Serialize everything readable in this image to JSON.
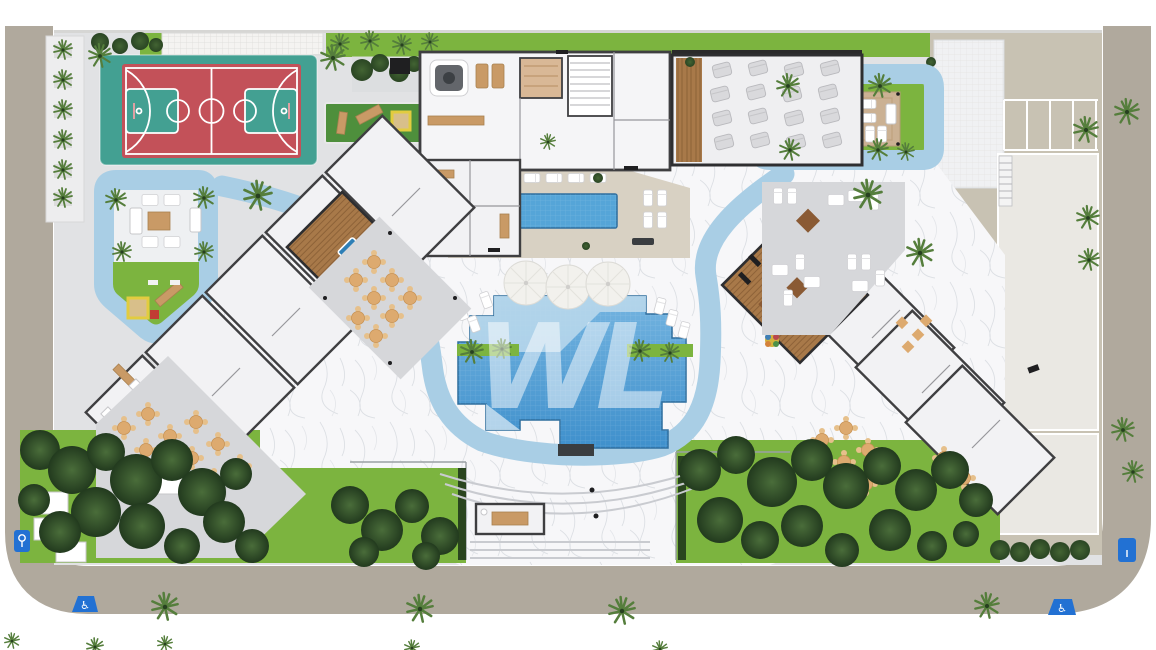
{
  "canvas": {
    "width": 1156,
    "height": 650
  },
  "watermark": {
    "letters": "WL"
  },
  "signs": {
    "handicap_glyph": "♿"
  },
  "palette": {
    "page_bg": "#ffffff",
    "road": "#b0a99d",
    "curb": "#ffffff",
    "concrete": "#e1e2e4",
    "concrete_dark": "#d6d7da",
    "marble": "#f7f7f9",
    "marble_vein": "#d6d9de",
    "deck_beige": "#d8d1c3",
    "roof_beige": "#c8c2b3",
    "panel_light": "#eae8e3",
    "panel_white": "#f0f1f3",
    "water": "#4e9fd4",
    "water_deep": "#3f90cc",
    "water_pale": "#bcd9ec",
    "water_light": "#a9cee5",
    "lap_water": "#55a5d8",
    "court_teal": "#43a092",
    "court_red": "#c35159",
    "line_white": "#ffffff",
    "lawn": "#7cb43f",
    "lawn_dark": "#5f9a33",
    "tree_dark": "#2a451f",
    "tree_mid": "#41642f",
    "tree_light": "#557e3c",
    "wood": "#a87949",
    "wood_dark": "#88603a",
    "wood_light": "#c99a66",
    "pool_table": "#2e7fb6",
    "sand": "#d8bf8a",
    "sand_frame": "#e2cc3f",
    "furn_white": "#ffffff",
    "furn_gray": "#d9d9dc",
    "furn_edge": "#b9b9bd",
    "chair_tan": "#ddaa6f",
    "wall": "#3f3f41",
    "wall_light": "#97979b",
    "sign_blue": "#2271d3",
    "spa_gray": "#63666b",
    "black": "#1f1f21"
  }
}
